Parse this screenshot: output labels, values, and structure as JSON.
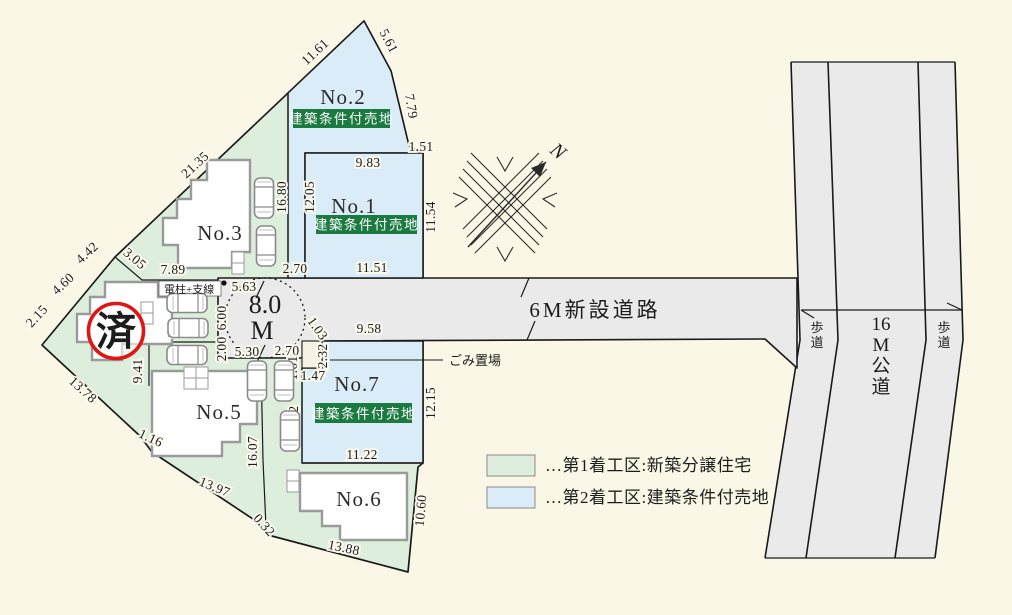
{
  "colors": {
    "background": "#fbf7e6",
    "zone1_green": "#ddefdc",
    "zone2_blue": "#d9ecf7",
    "road_gray": "#eaeaea",
    "badge_green": "#1b7a40",
    "stamp_red": "#e01515",
    "line_black": "#1a1a1a"
  },
  "stamp": {
    "text": "済"
  },
  "badge_text": "建築条件付売地",
  "lots": [
    {
      "name": "No.2",
      "x": 343,
      "y": 104,
      "badge": {
        "x": 293,
        "y": 109,
        "w": 97,
        "h": 19
      }
    },
    {
      "name": "No.1",
      "x": 354,
      "y": 213,
      "badge": {
        "x": 316,
        "y": 215,
        "w": 101,
        "h": 19
      }
    },
    {
      "name": "No.3",
      "x": 220,
      "y": 240
    },
    {
      "name": "No.5",
      "x": 219,
      "y": 419
    },
    {
      "name": "No.6",
      "x": 359,
      "y": 506
    },
    {
      "name": "No.7",
      "x": 357,
      "y": 391,
      "badge": {
        "x": 315,
        "y": 403,
        "w": 97,
        "h": 20
      }
    }
  ],
  "roads": {
    "main_label": "6M新設道路",
    "main_x": 595,
    "main_y": 317,
    "public_segments": [
      "16",
      "M",
      "公",
      "道"
    ],
    "public_x": 881,
    "public_y": 330,
    "sidewalk_segments": [
      "歩",
      "道"
    ],
    "sidewalk_left_x": 817,
    "sidewalk_right_x": 944,
    "sidewalk_y": 332,
    "circle_label_line1": "8.0",
    "circle_label_line2": "M"
  },
  "compass": {
    "north": "N"
  },
  "misc_labels": {
    "utility_pole": "電柱+支線",
    "utility_x": 164,
    "utility_y": 293,
    "garbage": "ごみ置場",
    "garbage_x": 449,
    "garbage_y": 365
  },
  "legend": [
    {
      "swatch": "#ddefdc",
      "text": "…第1着工区:新築分譲住宅",
      "x": 487,
      "y": 455
    },
    {
      "swatch": "#d9ecf7",
      "text": "…第2着工区:建築条件付売地",
      "x": 487,
      "y": 487
    }
  ],
  "dimensions": [
    {
      "t": "11.61",
      "x": 318,
      "y": 55,
      "r": -43
    },
    {
      "t": "5.61",
      "x": 385,
      "y": 43,
      "r": 62
    },
    {
      "t": "7.79",
      "x": 407,
      "y": 107,
      "r": 80
    },
    {
      "t": "1.51",
      "x": 421,
      "y": 151,
      "r": 0
    },
    {
      "t": "9.83",
      "x": 368,
      "y": 167,
      "r": 0
    },
    {
      "t": "16.80",
      "x": 286,
      "y": 197,
      "r": -90
    },
    {
      "t": "12.05",
      "x": 314,
      "y": 197,
      "r": -90
    },
    {
      "t": "11.54",
      "x": 435,
      "y": 217,
      "r": -90
    },
    {
      "t": "2.70",
      "x": 295,
      "y": 273,
      "r": 0
    },
    {
      "t": "11.51",
      "x": 372,
      "y": 272,
      "r": 0
    },
    {
      "t": "21.35",
      "x": 198,
      "y": 168,
      "r": -43
    },
    {
      "t": "3.05",
      "x": 132,
      "y": 262,
      "r": 40
    },
    {
      "t": "7.89",
      "x": 173,
      "y": 274,
      "r": 0
    },
    {
      "t": "4.42",
      "x": 90,
      "y": 256,
      "r": -43
    },
    {
      "t": "4.60",
      "x": 66,
      "y": 287,
      "r": -43
    },
    {
      "t": "2.15",
      "x": 40,
      "y": 319,
      "r": -47
    },
    {
      "t": "13.78",
      "x": 80,
      "y": 393,
      "r": 42
    },
    {
      "t": "9.41",
      "x": 142,
      "y": 371,
      "r": -90
    },
    {
      "t": "1.16",
      "x": 149,
      "y": 442,
      "r": 25
    },
    {
      "t": "13.97",
      "x": 213,
      "y": 491,
      "r": 22
    },
    {
      "t": "16.07",
      "x": 257,
      "y": 452,
      "r": -90
    },
    {
      "t": "0.32",
      "x": 261,
      "y": 528,
      "r": 48
    },
    {
      "t": "13.88",
      "x": 343,
      "y": 552,
      "r": 12
    },
    {
      "t": "10.60",
      "x": 425,
      "y": 511,
      "r": -85
    },
    {
      "t": "5.63",
      "x": 244,
      "y": 291,
      "r": 0
    },
    {
      "t": "6.00",
      "x": 226,
      "y": 318,
      "r": -90
    },
    {
      "t": "2.00",
      "x": 226,
      "y": 349,
      "r": -90
    },
    {
      "t": "5.30",
      "x": 247,
      "y": 356,
      "r": 0
    },
    {
      "t": "2.70",
      "x": 287,
      "y": 355,
      "r": 0
    },
    {
      "t": "5.67",
      "x": 180,
      "y": 337,
      "r": 0
    },
    {
      "t": "9.58",
      "x": 369,
      "y": 333,
      "r": 0
    },
    {
      "t": "1.03",
      "x": 314,
      "y": 331,
      "r": 55
    },
    {
      "t": "2.32",
      "x": 327,
      "y": 356,
      "r": -90
    },
    {
      "t": "1.47",
      "x": 313,
      "y": 380,
      "r": 0
    },
    {
      "t": "1.01",
      "x": 297,
      "y": 368,
      "r": -90
    },
    {
      "t": "9.12",
      "x": 298,
      "y": 418,
      "r": -90
    },
    {
      "t": "12.15",
      "x": 435,
      "y": 403,
      "r": -90
    },
    {
      "t": "11.22",
      "x": 362,
      "y": 459,
      "r": 0
    }
  ],
  "cars": [
    {
      "x": 264,
      "y": 198,
      "r": 0
    },
    {
      "x": 266,
      "y": 246,
      "r": 0
    },
    {
      "x": 187,
      "y": 303,
      "r": 90
    },
    {
      "x": 188,
      "y": 328,
      "r": 90
    },
    {
      "x": 187,
      "y": 355,
      "r": 90
    },
    {
      "x": 257,
      "y": 381,
      "r": 0
    },
    {
      "x": 284,
      "y": 381,
      "r": 0
    },
    {
      "x": 290,
      "y": 431,
      "r": 0
    }
  ]
}
